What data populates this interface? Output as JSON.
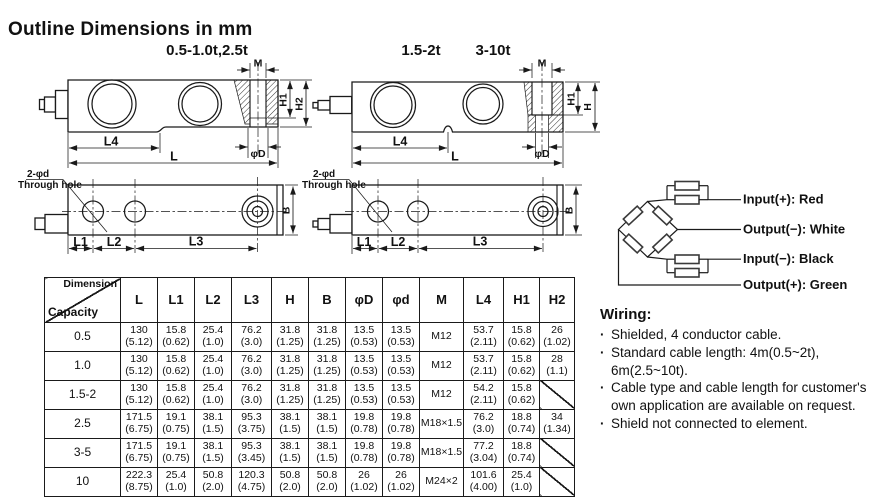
{
  "title": "Outline Dimensions in mm",
  "drawings": {
    "side_left": {
      "label": "0.5-1.0t,2.5t",
      "dim_m": "M",
      "dim_h1": "H1",
      "dim_h2": "H2",
      "dim_l4": "L4",
      "dim_l": "L",
      "dim_phi_d": "φD"
    },
    "side_right": {
      "label_a": "1.5-2t",
      "label_b": "3-10t",
      "dim_m": "M",
      "dim_h1": "H1",
      "dim_h": "H",
      "dim_l4": "L4",
      "dim_l": "L",
      "dim_phi_d": "φD"
    },
    "top_left": {
      "note_line1": "2-φd",
      "note_line2": "Through hole",
      "dim_l1": "L1",
      "dim_l2": "L2",
      "dim_l3": "L3",
      "dim_b": "B"
    },
    "top_right": {
      "note_line1": "2-φd",
      "note_line2": "Through hole",
      "dim_l1": "L1",
      "dim_l2": "L2",
      "dim_l3": "L3",
      "dim_b": "B"
    }
  },
  "bridge": {
    "labels": [
      "Input(+): Red",
      "Output(−): White",
      "Input(−): Black",
      "Output(+): Green"
    ]
  },
  "table": {
    "corner_top": "Dimension",
    "corner_bottom": "Capacity",
    "columns": [
      "L",
      "L1",
      "L2",
      "L3",
      "H",
      "B",
      "φD",
      "φd",
      "M",
      "L4",
      "H1",
      "H2"
    ],
    "rows": [
      {
        "capacity": "0.5",
        "cells": [
          "130\n(5.12)",
          "15.8\n(0.62)",
          "25.4\n(1.0)",
          "76.2\n(3.0)",
          "31.8\n(1.25)",
          "31.8\n(1.25)",
          "13.5\n(0.53)",
          "13.5\n(0.53)",
          "M12",
          "53.7\n(2.11)",
          "15.8\n(0.62)",
          "26\n(1.02)"
        ]
      },
      {
        "capacity": "1.0",
        "cells": [
          "130\n(5.12)",
          "15.8\n(0.62)",
          "25.4\n(1.0)",
          "76.2\n(3.0)",
          "31.8\n(1.25)",
          "31.8\n(1.25)",
          "13.5\n(0.53)",
          "13.5\n(0.53)",
          "M12",
          "53.7\n(2.11)",
          "15.8\n(0.62)",
          "28\n(1.1)"
        ]
      },
      {
        "capacity": "1.5-2",
        "cells": [
          "130\n(5.12)",
          "15.8\n(0.62)",
          "25.4\n(1.0)",
          "76.2\n(3.0)",
          "31.8\n(1.25)",
          "31.8\n(1.25)",
          "13.5\n(0.53)",
          "13.5\n(0.53)",
          "M12",
          "54.2\n(2.11)",
          "15.8\n(0.62)",
          null
        ]
      },
      {
        "capacity": "2.5",
        "cells": [
          "171.5\n(6.75)",
          "19.1\n(0.75)",
          "38.1\n(1.5)",
          "95.3\n(3.75)",
          "38.1\n(1.5)",
          "38.1\n(1.5)",
          "19.8\n(0.78)",
          "19.8\n(0.78)",
          "M18×1.5",
          "76.2\n(3.0)",
          "18.8\n(0.74)",
          "34\n(1.34)"
        ]
      },
      {
        "capacity": "3-5",
        "cells": [
          "171.5\n(6.75)",
          "19.1\n(0.75)",
          "38.1\n(1.5)",
          "95.3\n(3.45)",
          "38.1\n(1.5)",
          "38.1\n(1.5)",
          "19.8\n(0.78)",
          "19.8\n(0.78)",
          "M18×1.5",
          "77.2\n(3.04)",
          "18.8\n(0.74)",
          null
        ]
      },
      {
        "capacity": "10",
        "cells": [
          "222.3\n(8.75)",
          "25.4\n(1.0)",
          "50.8\n(2.0)",
          "120.3\n(4.75)",
          "50.8\n(2.0)",
          "50.8\n(2.0)",
          "26\n(1.02)",
          "26\n(1.02)",
          "M24×2",
          "101.6\n(4.00)",
          "25.4\n(1.0)",
          null
        ]
      }
    ]
  },
  "wiring": {
    "title": "Wiring:",
    "bullet": "·",
    "notes": [
      "Shielded, 4 conductor cable.",
      "Standard cable length: 4m(0.5~2t), 6m(2.5~10t).",
      "Cable type and cable length for customer's own application are available on request.",
      "Shield not connected to element."
    ]
  }
}
